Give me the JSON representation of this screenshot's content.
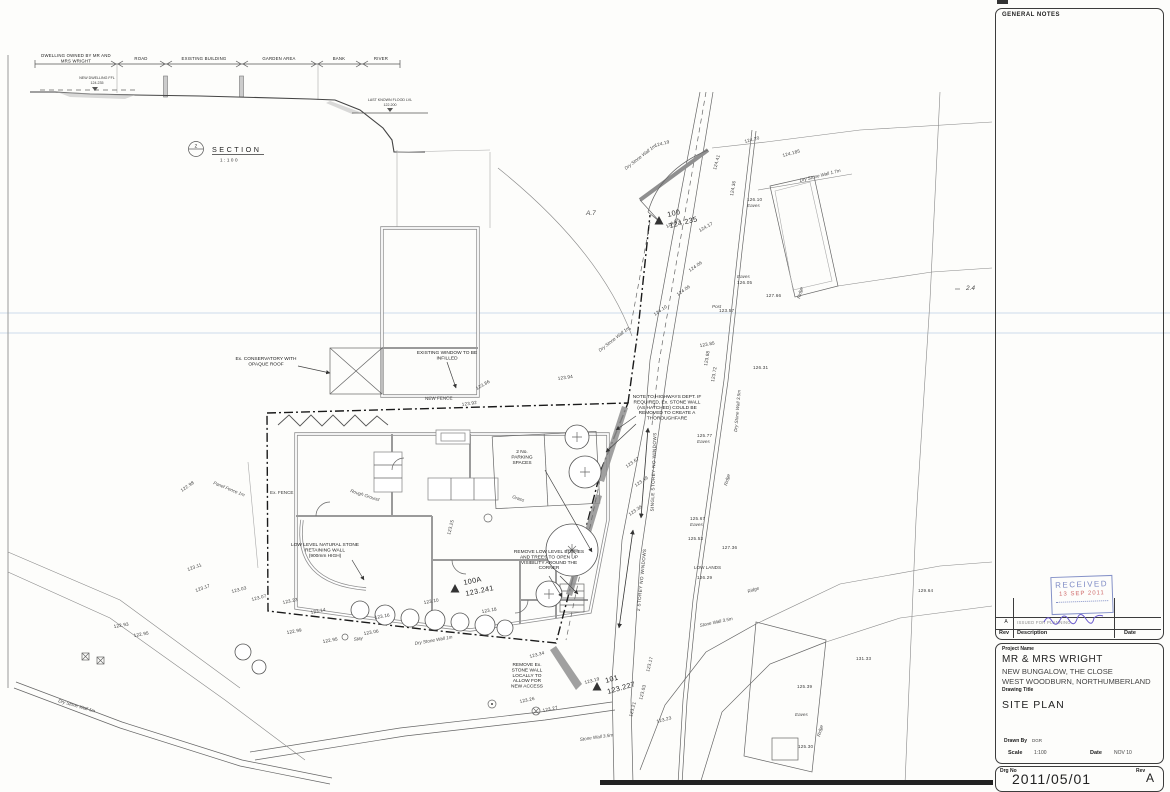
{
  "section": {
    "symbol_letter": "Z",
    "title": "SECTION",
    "scale": "1:100",
    "segments": [
      "DWELLING OWNED BY MR AND",
      "MRS WRIGHT",
      "ROAD",
      "EXISTING BUILDING",
      "GARDEN AREA",
      "BANK",
      "RIVER"
    ],
    "new_dwelling": [
      "NEW DWELLING FFL",
      "124.235"
    ],
    "flood": [
      "LAST KNOWN FLOOD LVL",
      "122.200"
    ]
  },
  "plan": {
    "stations": [
      {
        "name": "100",
        "value": "124.235",
        "x": 659,
        "y": 221,
        "r": -14
      },
      {
        "name": "100A",
        "value": "123.241",
        "x": 455,
        "y": 589,
        "r": -12
      },
      {
        "name": "101",
        "value": "123.227",
        "x": 597,
        "y": 687,
        "r": -16
      }
    ],
    "vertical_notes": [
      {
        "t": "SINGLE STOREY NO WINDOWS",
        "x": 655,
        "y": 472,
        "r": -88
      },
      {
        "t": "2 STOREY NO WINDOWS",
        "x": 643,
        "y": 580,
        "r": -84
      }
    ],
    "annotations": [
      {
        "lines": [
          "Ex. CONSERVATORY WITH",
          "OPAQUE ROOF"
        ],
        "x": 266,
        "y": 360
      },
      {
        "lines": [
          "EXISTING WINDOW TO BE",
          "INFILLED"
        ],
        "x": 447,
        "y": 354
      },
      {
        "lines": [
          "NOTE TO HIGHWAYS DEPT. IF",
          "REQUIRED, Ex. STONE WALL",
          "(AS HATCHED) COULD BE",
          "REMOVED TO CREATE A",
          "THOROUGHFARE"
        ],
        "x": 667,
        "y": 398
      },
      {
        "lines": [
          "2 No.",
          "PARKING",
          "SPACES"
        ],
        "x": 522,
        "y": 453
      },
      {
        "lines": [
          "LOW LEVEL NATURAL STONE",
          "RETAINING WALL",
          "(900mm HIGH)"
        ],
        "x": 325,
        "y": 546
      },
      {
        "lines": [
          "REMOVE LOW LEVEL BUSHES",
          "AND TREES TO OPEN UP",
          "VISIBILITY AROUND THE",
          "CORNER"
        ],
        "x": 549,
        "y": 553
      },
      {
        "lines": [
          "REMOVE Ex.",
          "STONE WALL",
          "LOCALLY TO",
          "ALLOW FOR",
          "NEW ACCESS"
        ],
        "x": 527,
        "y": 666
      }
    ],
    "labels": [
      {
        "t": "NEW FENCE",
        "x": 425,
        "y": 400,
        "r": -1
      },
      {
        "t": "Dry Stone Wall 1m",
        "x": 600,
        "y": 352,
        "r": -38,
        "i": 1
      },
      {
        "t": "Dry Stone Wall 1m",
        "x": 626,
        "y": 170,
        "r": -38,
        "i": 1
      },
      {
        "t": "Dry Stone Wall 1.7m",
        "x": 800,
        "y": 182,
        "r": -14,
        "i": 1
      },
      {
        "t": "Dry Stone Wall 3.5m",
        "x": 737,
        "y": 432,
        "r": -85,
        "i": 1
      },
      {
        "t": "Stone Wall 3.5m",
        "x": 700,
        "y": 627,
        "r": -12,
        "i": 1
      },
      {
        "t": "Stone Wall 3.5m",
        "x": 580,
        "y": 741,
        "r": -8,
        "i": 1
      },
      {
        "t": "Dry Stone Wall 1m",
        "x": 415,
        "y": 645,
        "r": -10,
        "i": 1
      },
      {
        "t": "Dry Stone Wall 1m",
        "x": 58,
        "y": 702,
        "r": 16,
        "i": 1
      },
      {
        "t": "Panel Fence 1m",
        "x": 213,
        "y": 484,
        "r": 22,
        "i": 1
      },
      {
        "t": "Ex. FENCE",
        "x": 270,
        "y": 494,
        "r": 0
      },
      {
        "t": "Rough Ground",
        "x": 350,
        "y": 492,
        "r": 18,
        "i": 1
      },
      {
        "t": "Grass",
        "x": 512,
        "y": 498,
        "r": 18,
        "i": 1
      },
      {
        "t": "LOW LANDS",
        "x": 694,
        "y": 569,
        "r": 0
      },
      {
        "t": "Eaves",
        "x": 747,
        "y": 207,
        "r": 0,
        "i": 1
      },
      {
        "t": "Eaves",
        "x": 737,
        "y": 278,
        "r": 0,
        "i": 1
      },
      {
        "t": "Eaves",
        "x": 690,
        "y": 526,
        "r": 0,
        "i": 1
      },
      {
        "t": "Eaves",
        "x": 697,
        "y": 443,
        "r": 0,
        "i": 1
      },
      {
        "t": "Eaves",
        "x": 795,
        "y": 716,
        "r": 0,
        "i": 1
      },
      {
        "t": "Ridge",
        "x": 800,
        "y": 299,
        "r": -75,
        "i": 1
      },
      {
        "t": "Ridge",
        "x": 727,
        "y": 486,
        "r": -75,
        "i": 1
      },
      {
        "t": "Ridge",
        "x": 748,
        "y": 593,
        "r": -18,
        "i": 1
      },
      {
        "t": "Ridge",
        "x": 820,
        "y": 737,
        "r": -75,
        "i": 1
      },
      {
        "t": "Post",
        "x": 712,
        "y": 308,
        "r": 0,
        "i": 1
      },
      {
        "t": "Stay",
        "x": 354,
        "y": 641,
        "r": -10,
        "i": 1
      },
      {
        "t": "A.7",
        "x": 586,
        "y": 215,
        "r": 0,
        "i": 1,
        "big": 1
      },
      {
        "t": "2.4",
        "x": 966,
        "y": 290,
        "r": 0,
        "i": 1,
        "big": 1
      }
    ],
    "levels": [
      {
        "t": "124.19",
        "x": 655,
        "y": 147,
        "r": -15
      },
      {
        "t": "124.20",
        "x": 745,
        "y": 143,
        "r": -15
      },
      {
        "t": "124.185",
        "x": 783,
        "y": 157,
        "r": -15
      },
      {
        "t": "124.41",
        "x": 716,
        "y": 170,
        "r": -75
      },
      {
        "t": "124.36",
        "x": 733,
        "y": 196,
        "r": -80
      },
      {
        "t": "126.10",
        "x": 747,
        "y": 201,
        "r": 0
      },
      {
        "t": "124.17",
        "x": 700,
        "y": 232,
        "r": -30
      },
      {
        "t": "124.05",
        "x": 667,
        "y": 228,
        "r": -30
      },
      {
        "t": "124.06",
        "x": 690,
        "y": 272,
        "r": -35
      },
      {
        "t": "124.06",
        "x": 678,
        "y": 296,
        "r": -35
      },
      {
        "t": "124.10",
        "x": 655,
        "y": 316,
        "r": -35
      },
      {
        "t": "123.85",
        "x": 700,
        "y": 347,
        "r": -10
      },
      {
        "t": "126.05",
        "x": 737,
        "y": 284,
        "r": 0
      },
      {
        "t": "127.66",
        "x": 766,
        "y": 297,
        "r": 0
      },
      {
        "t": "123.57",
        "x": 719,
        "y": 312,
        "r": 0
      },
      {
        "t": "126.31",
        "x": 753,
        "y": 369,
        "r": 0
      },
      {
        "t": "123.88",
        "x": 707,
        "y": 366,
        "r": -80
      },
      {
        "t": "123.72",
        "x": 714,
        "y": 382,
        "r": -80
      },
      {
        "t": "123.94",
        "x": 558,
        "y": 380,
        "r": -8
      },
      {
        "t": "123.86",
        "x": 477,
        "y": 390,
        "r": -30
      },
      {
        "t": "123.92",
        "x": 462,
        "y": 406,
        "r": -8
      },
      {
        "t": "123.67",
        "x": 627,
        "y": 468,
        "r": -35
      },
      {
        "t": "123.49",
        "x": 636,
        "y": 487,
        "r": -35
      },
      {
        "t": "123.36",
        "x": 630,
        "y": 516,
        "r": -35
      },
      {
        "t": "125.77",
        "x": 697,
        "y": 437,
        "r": 0
      },
      {
        "t": "125.67",
        "x": 690,
        "y": 520,
        "r": 0
      },
      {
        "t": "125.53",
        "x": 688,
        "y": 540,
        "r": 0
      },
      {
        "t": "127.36",
        "x": 722,
        "y": 549,
        "r": 0
      },
      {
        "t": "126.29",
        "x": 697,
        "y": 579,
        "r": 0
      },
      {
        "t": "123.25",
        "x": 450,
        "y": 535,
        "r": -75
      },
      {
        "t": "122.98",
        "x": 182,
        "y": 492,
        "r": -35
      },
      {
        "t": "123.11",
        "x": 188,
        "y": 571,
        "r": -20
      },
      {
        "t": "123.17",
        "x": 196,
        "y": 592,
        "r": -20
      },
      {
        "t": "123.03",
        "x": 232,
        "y": 593,
        "r": -15
      },
      {
        "t": "123.07",
        "x": 252,
        "y": 601,
        "r": -15
      },
      {
        "t": "122.93",
        "x": 114,
        "y": 628,
        "r": -10
      },
      {
        "t": "122.95",
        "x": 134,
        "y": 637,
        "r": -10
      },
      {
        "t": "123.23",
        "x": 283,
        "y": 604,
        "r": -12
      },
      {
        "t": "123.14",
        "x": 311,
        "y": 614,
        "r": -12
      },
      {
        "t": "123.16",
        "x": 375,
        "y": 619,
        "r": -10
      },
      {
        "t": "122.99",
        "x": 287,
        "y": 634,
        "r": -10
      },
      {
        "t": "122.95",
        "x": 323,
        "y": 643,
        "r": -10
      },
      {
        "t": "123.06",
        "x": 364,
        "y": 635,
        "r": -10
      },
      {
        "t": "123.10",
        "x": 424,
        "y": 604,
        "r": -10
      },
      {
        "t": "123.18",
        "x": 482,
        "y": 613,
        "r": -10
      },
      {
        "t": "123.34",
        "x": 530,
        "y": 658,
        "r": -15
      },
      {
        "t": "123.19",
        "x": 585,
        "y": 684,
        "r": -15
      },
      {
        "t": "123.26",
        "x": 520,
        "y": 703,
        "r": -12
      },
      {
        "t": "123.27",
        "x": 543,
        "y": 712,
        "r": -12
      },
      {
        "t": "123.17",
        "x": 649,
        "y": 672,
        "r": -75
      },
      {
        "t": "123.03",
        "x": 642,
        "y": 700,
        "r": -75
      },
      {
        "t": "123.21",
        "x": 632,
        "y": 717,
        "r": -75
      },
      {
        "t": "123.23",
        "x": 657,
        "y": 723,
        "r": -15
      },
      {
        "t": "125.39",
        "x": 797,
        "y": 688,
        "r": 0
      },
      {
        "t": "125.30",
        "x": 798,
        "y": 748,
        "r": 0
      },
      {
        "t": "131.33",
        "x": 856,
        "y": 660,
        "r": 0
      },
      {
        "t": "129.64",
        "x": 918,
        "y": 592,
        "r": 0
      }
    ]
  },
  "panel": {
    "general_notes_title": "GENERAL NOTES",
    "stamp": {
      "title": "RECEIVED",
      "date": "13 SEP 2011"
    },
    "revision_table": {
      "headers": {
        "rev": "Rev",
        "description": "Description",
        "date": "Date"
      },
      "entries": [
        {
          "rev": "A",
          "description": "ISSUED FOR PLANNING",
          "date": ""
        }
      ]
    },
    "title_block": {
      "project_name_label": "Project Name",
      "project_name": "MR & MRS WRIGHT",
      "address_line1": "NEW BUNGALOW, THE CLOSE",
      "address_line2": "WEST WOODBURN, NORTHUMBERLAND",
      "drawing_title_label": "Drawing Title",
      "drawing_title": "SITE PLAN",
      "drawn_by_label": "Drawn By",
      "drawn_by": "DGR",
      "scale_label": "Scale",
      "scale": "1:100",
      "date_label": "Date",
      "date": "NOV 10",
      "drg_no_label": "Drg No",
      "drg_no": "2011/05/01",
      "rev_label": "Rev",
      "rev": "A"
    }
  }
}
